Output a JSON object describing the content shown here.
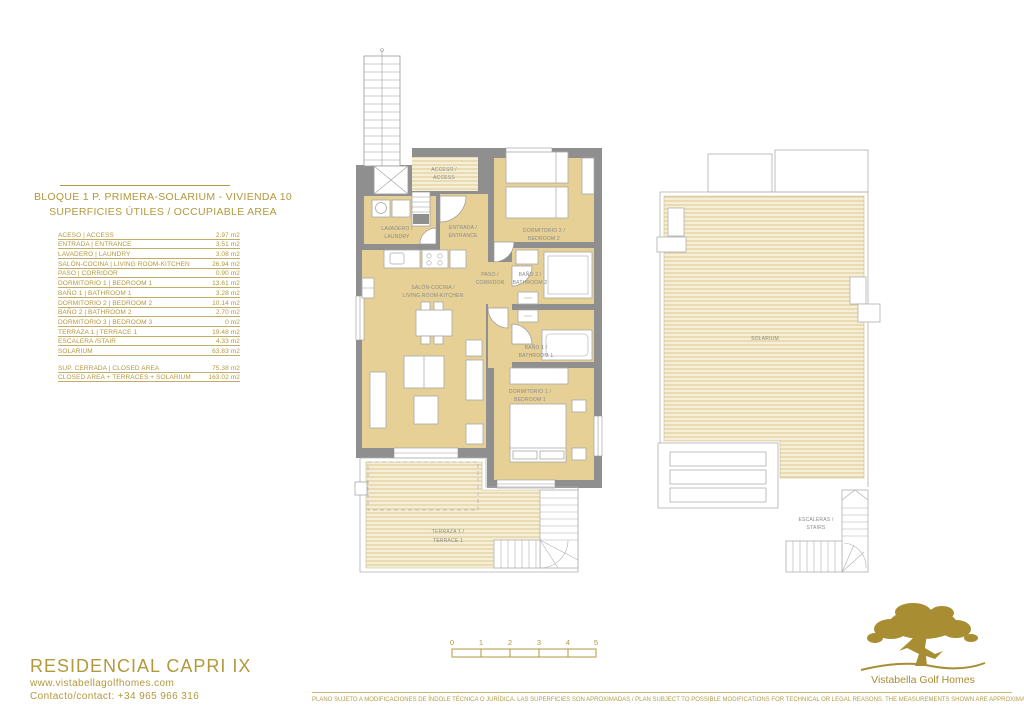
{
  "colors": {
    "gold": "#b2993e",
    "wall": "#8f8f8f",
    "floor": "#e6d096",
    "deck_line": "#dcc88e",
    "deck_bg": "#f6eed6"
  },
  "header": {
    "title": "BLOQUE 1 P. PRIMERA-SOLARIUM - VIVIENDA 10",
    "subtitle": "SUPERFICIES ÚTILES / OCCUPIABLE AREA"
  },
  "areas": {
    "rows": [
      {
        "label": "ACESO | ACCESS",
        "value": "2.97 m2"
      },
      {
        "label": "ENTRADA | ENTRANCE",
        "value": "3.51 m2"
      },
      {
        "label": "LAVADERO | LAUNDRY",
        "value": "3.08 m2"
      },
      {
        "label": "SALÓN-COCINA | LIVING ROOM-KITCHEN",
        "value": "26.94 m2"
      },
      {
        "label": "PASO | CORRIDOR",
        "value": "0.90 m2"
      },
      {
        "label": "DORMITORIO 1 | BEDROOM 1",
        "value": "13.61 m2"
      },
      {
        "label": "BAÑO 1 | BATHROOM 1",
        "value": "3.28 m2"
      },
      {
        "label": "DORMITORIO 2 | BEDROOM 2",
        "value": "10.14 m2"
      },
      {
        "label": "BAÑO 2 | BATHROOM 2",
        "value": "2.70 m2"
      },
      {
        "label": "DORMITORIO 3 | BEDROOM 3",
        "value": "0 m2"
      },
      {
        "label": "TERRAZA 1 | TERRACE 1",
        "value": "19.48 m2"
      },
      {
        "label": "ESCALERA /STAIR",
        "value": "4.33 m2"
      },
      {
        "label": "SOLARIUM",
        "value": "63.83 m2"
      }
    ],
    "summary": [
      {
        "label": "SUP. CERRADA | CLOSED AREA",
        "value": "75.38 m2"
      },
      {
        "label": "CLOSED AREA + TERRACES + SOLARIUM",
        "value": "163.02 m2"
      }
    ]
  },
  "plan": {
    "acceso_1": "ACCESO /",
    "acceso_2": "ACCESS",
    "lavadero_1": "LAVADERO /",
    "lavadero_2": "LAUNDRY",
    "entrada_1": "ENTRADA /",
    "entrada_2": "ENTRANCE",
    "dormitorio2_1": "DORMITORIO 2 /",
    "dormitorio2_2": "BEDROOM 2",
    "paso_1": "PASO /",
    "paso_2": "CORRIDOR",
    "bano2_1": "BAÑO 2 /",
    "bano2_2": "BATHROOM 2",
    "salon_1": "SALÓN-COCINA /",
    "salon_2": "LIVING ROOM-KITCHEN",
    "bano1_1": "BAÑO 1 /",
    "bano1_2": "BATHROOM 1",
    "dormitorio1_1": "DORMITORIO 1 /",
    "dormitorio1_2": "BEDROOM 1",
    "terraza_1": "TERRAZA 1 /",
    "terraza_2": "TERRACE 1",
    "solarium": "SOLARIUM",
    "escaleras_1": "ESCALERAS /",
    "escaleras_2": "STAIRS"
  },
  "scalebar": {
    "ticks": [
      "0",
      "1",
      "2",
      "3",
      "4",
      "5"
    ]
  },
  "footer": {
    "residence": "RESIDENCIAL CAPRI IX",
    "website": "www.vistabellagolfhomes.com",
    "contact": "Contacto/contact: +34 965 966 316",
    "disclaimer": "PLANO SUJETO A MODIFICACIONES DE ÍNDOLE TÉCNICA O JURÍDICA. LAS SUPERFICIES SON APROXIMADAS / PLAN SUBJECT TO POSSIBLE MODIFICATIONS FOR TECHNICAL OR LEGAL REASONS. THE MEASUREMENTS SHOWN ARE APPROXIMATE",
    "brand": "Vistabella Golf Homes"
  }
}
